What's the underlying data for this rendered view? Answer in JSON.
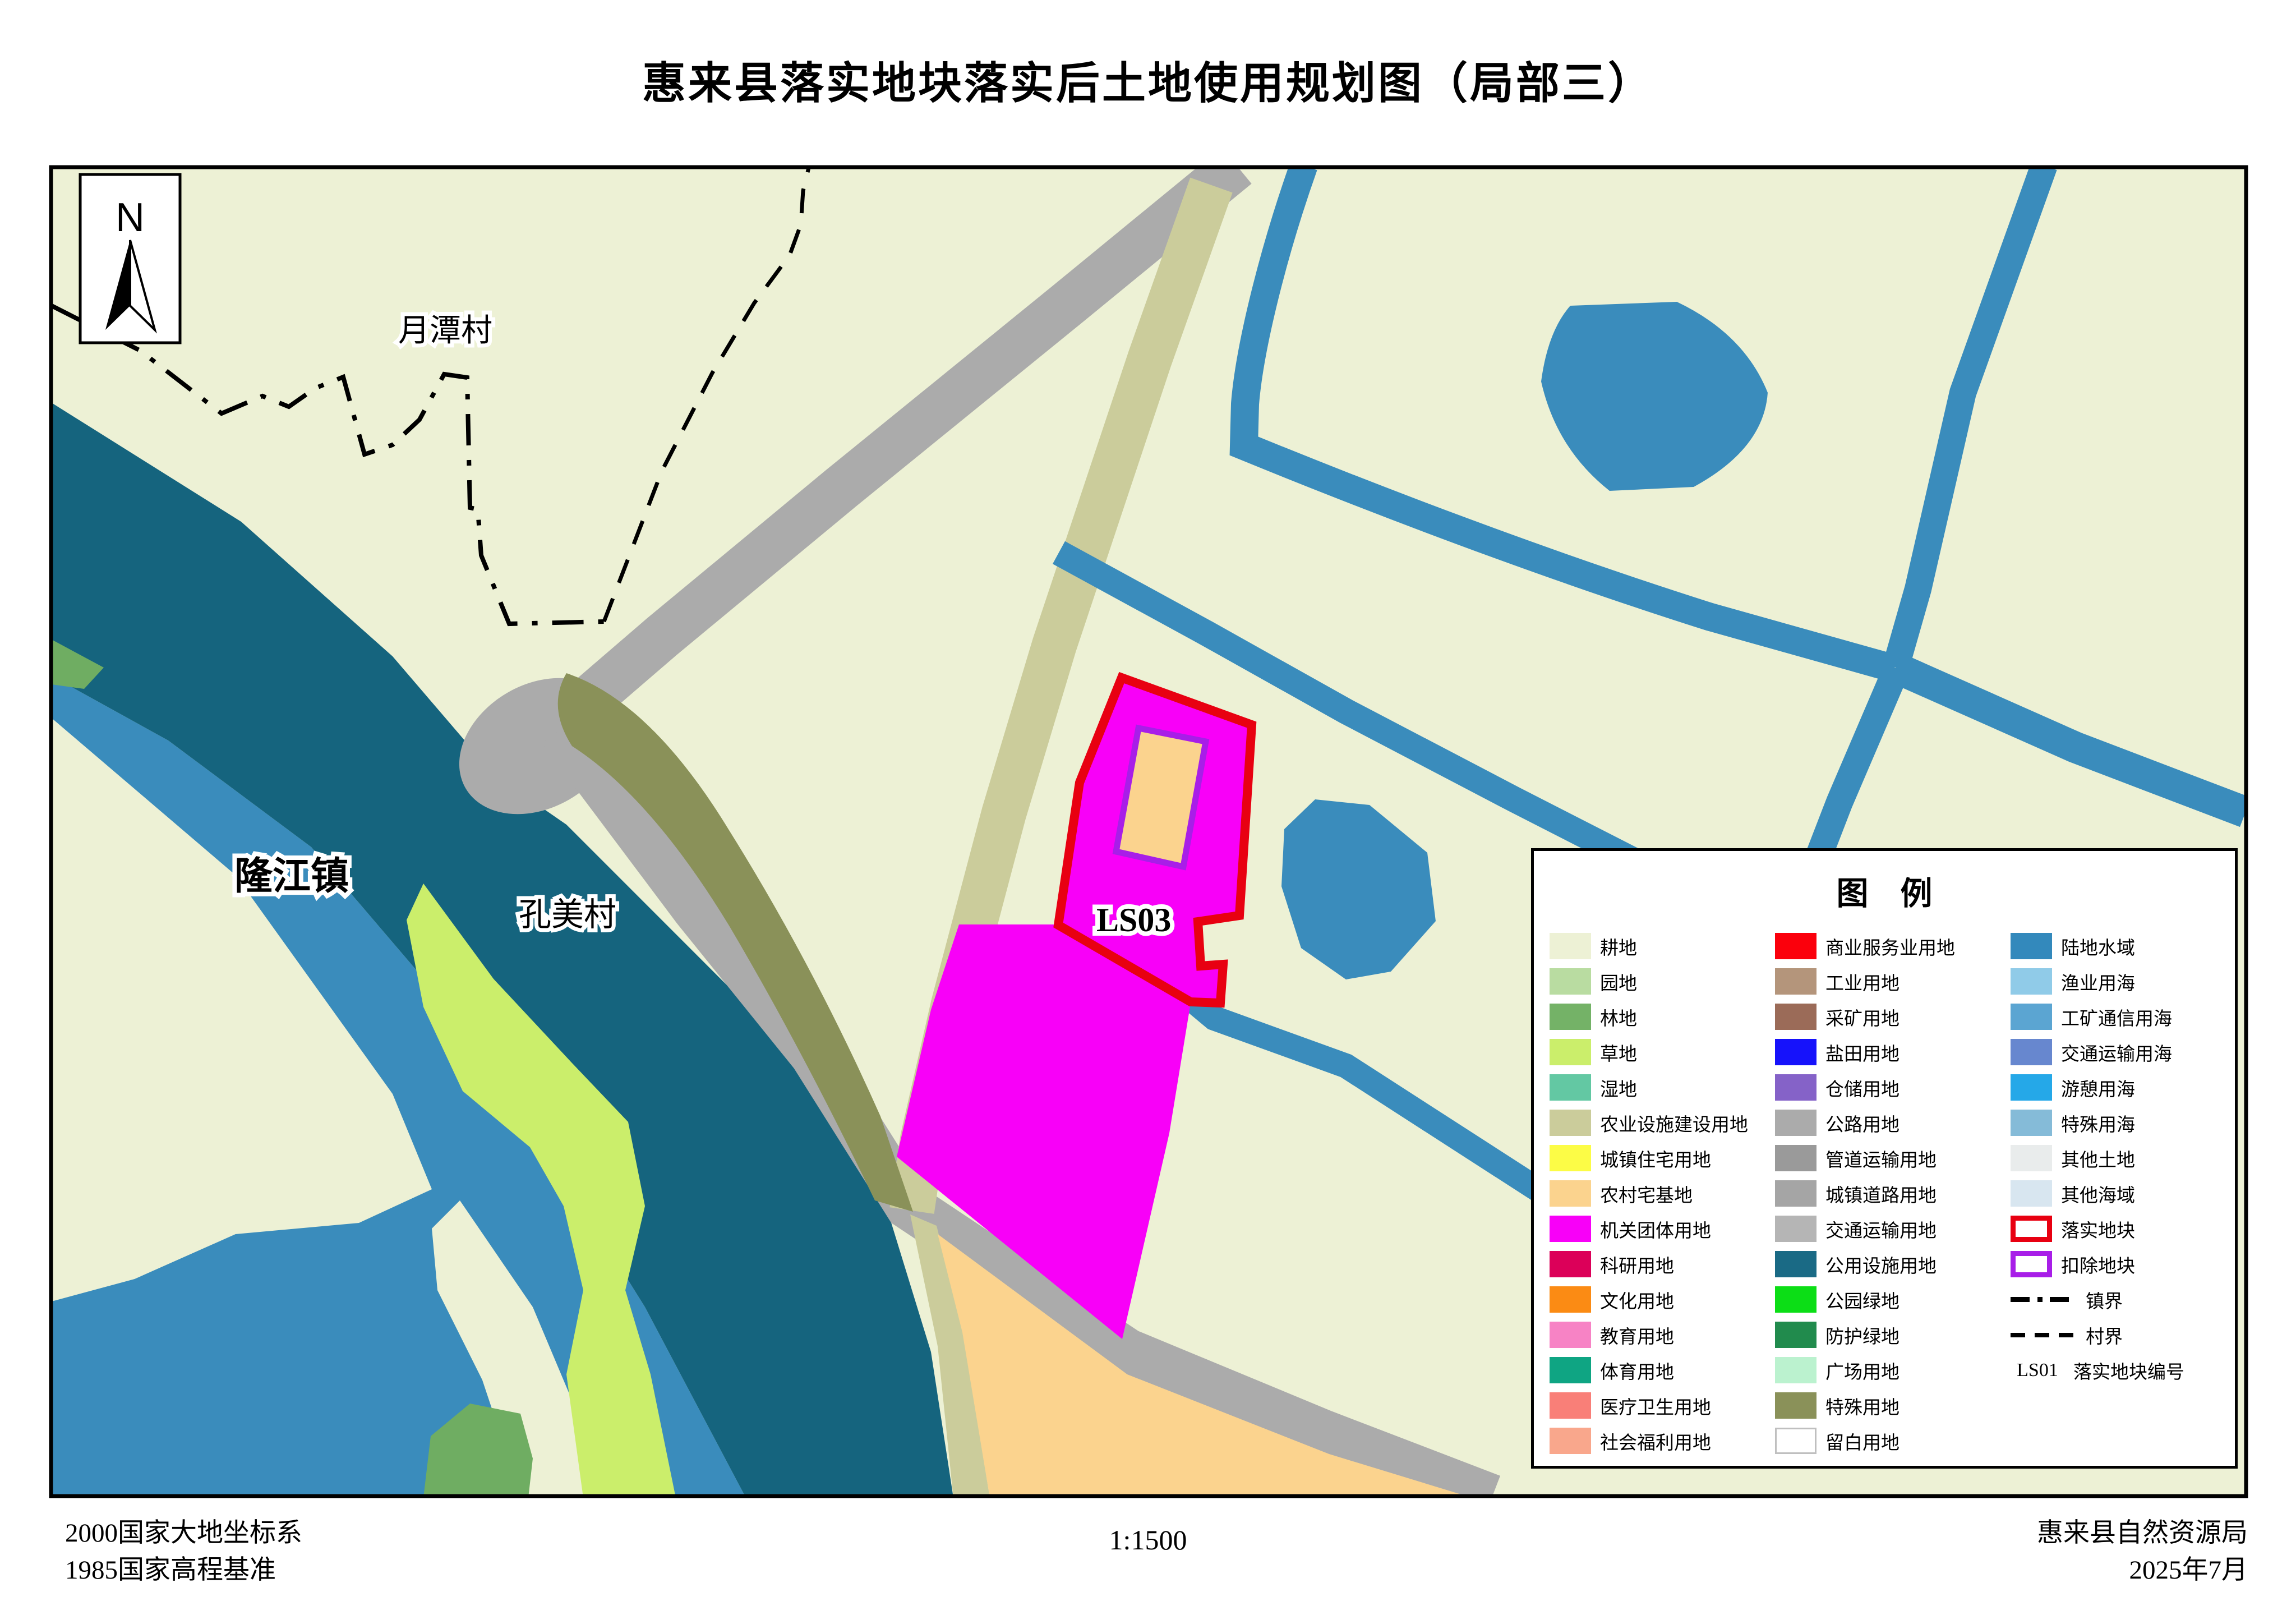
{
  "title": "惠来县落实地块落实后土地使用规划图（局部三）",
  "north_label": "N",
  "map_labels": {
    "village_top": "月潭村",
    "town_left": "隆江镇",
    "village_mid": "孔美村",
    "parcel_code": "LS03"
  },
  "footer": {
    "coord_system": "2000国家大地坐标系",
    "height_datum": "1985国家高程基准",
    "scale": "1:1500",
    "agency": "惠来县自然资源局",
    "date": "2025年7月"
  },
  "palette": {
    "cream": "#EDF1D5",
    "water": "#3A8CBC",
    "teal": "#15647E",
    "grass": "#CBEE6B",
    "forest": "#6FAD62",
    "khaki": "#CBCC9B",
    "olive": "#8A9159",
    "road": "#ABABAB",
    "peach": "#FBD38E",
    "magenta": "#F800F8",
    "red_outline": "#E80011",
    "purple_outline": "#A81EE8",
    "black": "#000000",
    "white": "#FFFFFF"
  },
  "legend": {
    "title": "图　例",
    "col1": [
      {
        "label": "耕地",
        "color": "#EDF1D5"
      },
      {
        "label": "园地",
        "color": "#B9DCA1"
      },
      {
        "label": "林地",
        "color": "#74B267"
      },
      {
        "label": "草地",
        "color": "#CBEE6B"
      },
      {
        "label": "湿地",
        "color": "#63C8A3"
      },
      {
        "label": "农业设施建设用地",
        "color": "#CBCC9B"
      },
      {
        "label": "城镇住宅用地",
        "color": "#FCFC46"
      },
      {
        "label": "农村宅基地",
        "color": "#FBD38E"
      },
      {
        "label": "机关团体用地",
        "color": "#F800F8"
      },
      {
        "label": "科研用地",
        "color": "#DC0059"
      },
      {
        "label": "文化用地",
        "color": "#FB8B14"
      },
      {
        "label": "教育用地",
        "color": "#F783C5"
      },
      {
        "label": "体育用地",
        "color": "#0FA583"
      },
      {
        "label": "医疗卫生用地",
        "color": "#F97F78"
      },
      {
        "label": "社会福利用地",
        "color": "#F9A78C"
      }
    ],
    "col2": [
      {
        "label": "商业服务业用地",
        "color": "#FB000C"
      },
      {
        "label": "工业用地",
        "color": "#B4957B"
      },
      {
        "label": "采矿用地",
        "color": "#9B6B58"
      },
      {
        "label": "盐田用地",
        "color": "#1612FB"
      },
      {
        "label": "仓储用地",
        "color": "#8562C8"
      },
      {
        "label": "公路用地",
        "color": "#ABABAB"
      },
      {
        "label": "管道运输用地",
        "color": "#9A9A9A"
      },
      {
        "label": "城镇道路用地",
        "color": "#A5A5A5"
      },
      {
        "label": "交通运输用地",
        "color": "#B5B5B5"
      },
      {
        "label": "公用设施用地",
        "color": "#1A6A85"
      },
      {
        "label": "公园绿地",
        "color": "#0CDE16"
      },
      {
        "label": "防护绿地",
        "color": "#218B4D"
      },
      {
        "label": "广场用地",
        "color": "#BBF2CF"
      },
      {
        "label": "特殊用地",
        "color": "#8A9159"
      },
      {
        "label": "留白用地",
        "color": "#FFFFFF",
        "type": "blank"
      }
    ],
    "col3": [
      {
        "label": "陆地水域",
        "color": "#3389BC"
      },
      {
        "label": "渔业用海",
        "color": "#90CBE8"
      },
      {
        "label": "工矿通信用海",
        "color": "#5BA5D2"
      },
      {
        "label": "交通运输用海",
        "color": "#6787CF"
      },
      {
        "label": "游憩用海",
        "color": "#25A8E8"
      },
      {
        "label": "特殊用海",
        "color": "#85BBD8"
      },
      {
        "label": "其他土地",
        "color": "#E9ECEC"
      },
      {
        "label": "其他海域",
        "color": "#D8E6F0"
      },
      {
        "label": "落实地块",
        "type": "outline",
        "color": "#E80011"
      },
      {
        "label": "扣除地块",
        "type": "outline",
        "color": "#A81EE8"
      },
      {
        "label": "镇界",
        "type": "line-town"
      },
      {
        "label": "村界",
        "type": "line-village"
      },
      {
        "label": "落实地块编号",
        "type": "code",
        "code": "LS01"
      }
    ]
  }
}
